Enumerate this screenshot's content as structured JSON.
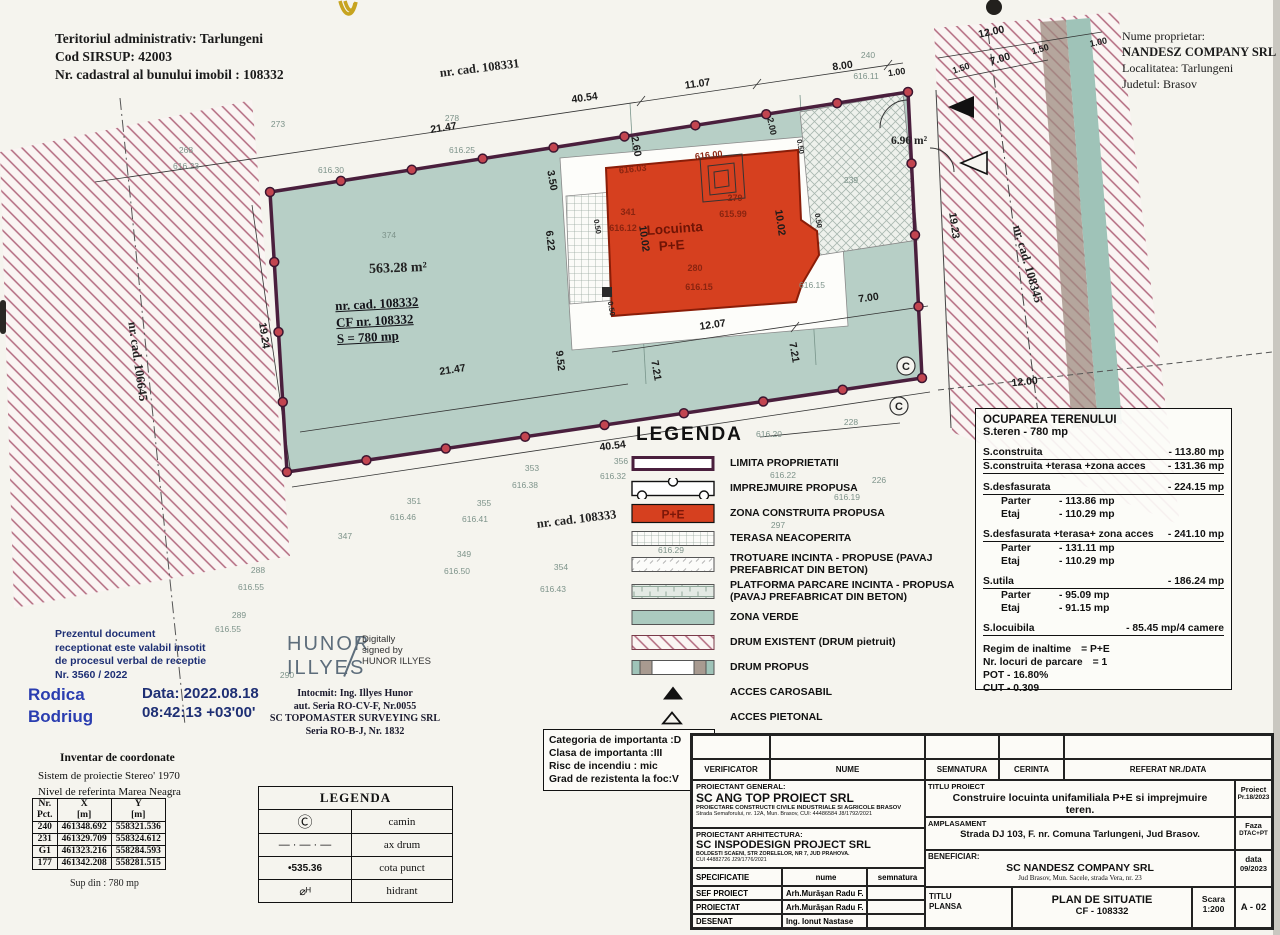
{
  "header": {
    "admin": [
      "Teritoriul administrativ: Tarlungeni",
      "Cod SIRSUP:  42003",
      "Nr. cadastral al bunului imobil : 108332"
    ],
    "owner": [
      "Nume proprietar:",
      "NANDESZ COMPANY SRL",
      "Localitatea: Tarlungeni",
      "Judetul: Brasov"
    ]
  },
  "plan": {
    "parcel_id": [
      "nr. cad. 108332",
      "CF nr. 108332",
      "S = 780 mp"
    ],
    "boundary": [
      [
        270,
        192
      ],
      [
        908,
        92
      ],
      [
        922,
        378
      ],
      [
        287,
        472
      ]
    ],
    "marker_counts": [
      9,
      4,
      8,
      4
    ],
    "colors": {
      "green": "#b7cfc6",
      "boundary": "#4a1f3d",
      "marker": "#c24550",
      "building": "#d6401f",
      "hatch": "#b2697e",
      "strip_teal": "#9fc3b8",
      "strip_brown": "#9d8b80"
    },
    "labels": [
      [
        "nr. cad. 108331",
        480,
        72,
        -7,
        "cad"
      ],
      [
        "40.54",
        585,
        101,
        -8,
        "dim"
      ],
      [
        "11.07",
        698,
        87,
        -8,
        "dim"
      ],
      [
        "8.00",
        843,
        69,
        -8,
        "dim"
      ],
      [
        "1.00",
        897,
        75,
        -8,
        "dims"
      ],
      [
        "240",
        868,
        58,
        0,
        "faint"
      ],
      [
        "616.11",
        866,
        79,
        0,
        "faint"
      ],
      [
        "12.00",
        992,
        35,
        -12,
        "dim"
      ],
      [
        "1.00",
        1099,
        45,
        -12,
        "dims"
      ],
      [
        "1.50",
        962,
        71,
        -18,
        "dims"
      ],
      [
        "7.00",
        1001,
        62,
        -16,
        "dim"
      ],
      [
        "1.50",
        1041,
        52,
        -16,
        "dims"
      ],
      [
        "19.23",
        951,
        226,
        82,
        "dim"
      ],
      [
        "nr. cad. 108345",
        1024,
        265,
        74,
        "cad"
      ],
      [
        "nr. cad. 106645",
        134,
        362,
        82,
        "cad"
      ],
      [
        "19.24",
        261,
        336,
        82,
        "dim"
      ],
      [
        "21.47",
        444,
        131,
        -9,
        "dim"
      ],
      [
        "268",
        186,
        153,
        0,
        "faint"
      ],
      [
        "616.23",
        186,
        169,
        0,
        "faint"
      ],
      [
        "273",
        278,
        127,
        0,
        "faint"
      ],
      [
        "278",
        452,
        121,
        0,
        "faint"
      ],
      [
        "616.30",
        331,
        173,
        0,
        "faint"
      ],
      [
        "616.25",
        462,
        153,
        0,
        "faint"
      ],
      [
        "2.60",
        633,
        147,
        80,
        "dim"
      ],
      [
        "3.50",
        549,
        181,
        80,
        "dim"
      ],
      [
        "2.00",
        769,
        127,
        78,
        "dims"
      ],
      [
        "6.22",
        547,
        241,
        84,
        "dim"
      ],
      [
        "9.52",
        557,
        361,
        84,
        "dim"
      ],
      [
        "10.02",
        641,
        239,
        82,
        "dim"
      ],
      [
        "10.02",
        777,
        223,
        82,
        "dim"
      ],
      [
        "21.47",
        453,
        373,
        -9,
        "dim"
      ],
      [
        "7.21",
        653,
        371,
        80,
        "dim"
      ],
      [
        "7.21",
        791,
        353,
        80,
        "dim"
      ],
      [
        "12.07",
        713,
        328,
        -8,
        "dim"
      ],
      [
        "7.00",
        869,
        301,
        -8,
        "dim"
      ],
      [
        "563.28 m²",
        398,
        272,
        -2,
        "area"
      ],
      [
        "Locuinta",
        675,
        233,
        -4,
        "bld"
      ],
      [
        "P+E",
        672,
        250,
        -4,
        "bld"
      ],
      [
        "616.03",
        633,
        172,
        -6,
        "red"
      ],
      [
        "616.00",
        709,
        158,
        -6,
        "red"
      ],
      [
        "341",
        628,
        215,
        0,
        "red"
      ],
      [
        "616.12",
        623,
        231,
        0,
        "red"
      ],
      [
        "279",
        735,
        201,
        0,
        "red"
      ],
      [
        "615.99",
        733,
        217,
        0,
        "red"
      ],
      [
        "280",
        695,
        271,
        0,
        "red"
      ],
      [
        "616.15",
        699,
        290,
        0,
        "red"
      ],
      [
        "616.15",
        812,
        288,
        0,
        "faint"
      ],
      [
        "239",
        851,
        183,
        0,
        "faint"
      ],
      [
        "6.96 m²",
        909,
        144,
        0,
        "areas"
      ],
      [
        "0.50",
        798,
        147,
        80,
        "box"
      ],
      [
        "0.50",
        595,
        227,
        80,
        "box"
      ],
      [
        "0.50",
        816,
        221,
        80,
        "box"
      ],
      [
        "0.50",
        609,
        309,
        80,
        "box"
      ],
      [
        "40.54",
        613,
        449,
        -7,
        "dim"
      ],
      [
        "356",
        621,
        464,
        0,
        "faint"
      ],
      [
        "616.32",
        613,
        479,
        0,
        "faint"
      ],
      [
        "228",
        851,
        425,
        0,
        "faint"
      ],
      [
        "616.20",
        769,
        437,
        0,
        "faint"
      ],
      [
        "616.22",
        783,
        478,
        0,
        "faint"
      ],
      [
        "226",
        879,
        483,
        0,
        "faint"
      ],
      [
        "616.19",
        847,
        500,
        0,
        "faint"
      ],
      [
        "353",
        532,
        471,
        0,
        "faint"
      ],
      [
        "616.38",
        525,
        488,
        0,
        "faint"
      ],
      [
        "351",
        414,
        504,
        0,
        "faint"
      ],
      [
        "616.46",
        403,
        520,
        0,
        "faint"
      ],
      [
        "355",
        484,
        506,
        0,
        "faint"
      ],
      [
        "616.41",
        475,
        522,
        0,
        "faint"
      ],
      [
        "nr. cad. 108333",
        577,
        523,
        -7,
        "cad"
      ],
      [
        "347",
        345,
        539,
        0,
        "faint"
      ],
      [
        "349",
        464,
        557,
        0,
        "faint"
      ],
      [
        "616.50",
        457,
        574,
        0,
        "faint"
      ],
      [
        "354",
        561,
        570,
        0,
        "faint"
      ],
      [
        "616.43",
        553,
        592,
        0,
        "faint"
      ],
      [
        "288",
        258,
        573,
        0,
        "faint"
      ],
      [
        "616.55",
        251,
        590,
        0,
        "faint"
      ],
      [
        "289",
        239,
        618,
        0,
        "faint"
      ],
      [
        "616.55",
        228,
        632,
        0,
        "faint"
      ],
      [
        "290",
        287,
        678,
        0,
        "faint"
      ],
      [
        "374",
        389,
        238,
        0,
        "faint"
      ],
      [
        "12.00",
        1025,
        385,
        -6,
        "dim"
      ],
      [
        "297",
        778,
        528,
        0,
        "faint"
      ],
      [
        "616.25",
        669,
        569,
        0,
        "faint"
      ],
      [
        "616.29",
        671,
        553,
        0,
        "faint"
      ],
      [
        "C",
        906,
        370,
        0,
        "sym"
      ],
      [
        "C",
        899,
        410,
        0,
        "sym"
      ]
    ]
  },
  "legend_main": {
    "title": "LEGENDA",
    "items": [
      {
        "sym": "limita",
        "label": "LIMITA PROPRIETATII"
      },
      {
        "sym": "imprejmuire",
        "label": "IMPREJMUIRE PROPUSA"
      },
      {
        "sym": "zona-construita",
        "sym_text": "P+E",
        "label": "ZONA CONSTRUITA PROPUSA"
      },
      {
        "sym": "terasa",
        "label": "TERASA NEACOPERITA"
      },
      {
        "sym": "trotuare",
        "label": "TROTUARE INCINTA - PROPUSE (PAVAJ\nPREFABRICAT DIN BETON)"
      },
      {
        "sym": "platforma",
        "label": "PLATFORMA PARCARE INCINTA - PROPUSA\n(PAVAJ PREFABRICAT DIN BETON)"
      },
      {
        "sym": "zona-verde",
        "label": "ZONA VERDE"
      },
      {
        "sym": "drum-existent",
        "label": "DRUM EXISTENT (DRUM pietruit)"
      },
      {
        "sym": "drum-propus",
        "label": "DRUM PROPUS"
      },
      {
        "sym": "acces-carosabil",
        "label": "ACCES CAROSABIL"
      },
      {
        "sym": "acces-pietonal",
        "label": "ACCES PIETONAL"
      }
    ]
  },
  "ocupare": {
    "title": "OCUPAREA TERENULUI",
    "subtitle": "S.teren - 780 mp",
    "rows": [
      {
        "type": "main",
        "label": "S.construita",
        "value": "- 113.80 mp"
      },
      {
        "type": "main",
        "label": "S.construita +terasa +zona acces",
        "value": "- 131.36 mp"
      },
      {
        "type": "gap"
      },
      {
        "type": "main",
        "label": "S.desfasurata",
        "value": "- 224.15 mp"
      },
      {
        "type": "sub",
        "label": "Parter",
        "value": "- 113.86 mp"
      },
      {
        "type": "sub",
        "label": "Etaj",
        "value": "- 110.29 mp"
      },
      {
        "type": "gap"
      },
      {
        "type": "main",
        "label": "S.desfasurata +terasa+ zona acces",
        "value": "- 241.10 mp"
      },
      {
        "type": "sub",
        "label": "Parter",
        "value": "- 131.11 mp"
      },
      {
        "type": "sub",
        "label": "Etaj",
        "value": "- 110.29 mp"
      },
      {
        "type": "gap"
      },
      {
        "type": "main",
        "label": "S.utila",
        "value": "- 186.24 mp"
      },
      {
        "type": "sub",
        "label": "Parter",
        "value": "- 95.09 mp"
      },
      {
        "type": "sub",
        "label": "Etaj",
        "value": "- 91.15 mp"
      },
      {
        "type": "gap"
      },
      {
        "type": "main",
        "label": "S.locuibila",
        "value": "- 85.45 mp/4 camere"
      },
      {
        "type": "gap"
      },
      {
        "type": "plain",
        "label": "Regim de inaltime",
        "value": "= P+E"
      },
      {
        "type": "plain",
        "label": "Nr. locuri de parcare",
        "value": "= 1"
      },
      {
        "type": "plain",
        "label": "POT - 16.80%",
        "value": ""
      },
      {
        "type": "plain",
        "label": "CUT - 0.309",
        "value": ""
      }
    ]
  },
  "stamp": {
    "text": "Prezentul document\nreceptionat este valabil insotit\nde procesul verbal de receptie\nNr. 3560 / 2022",
    "name1": "Rodica",
    "name2": "Bodriug",
    "date1": "Data: 2022.08.18",
    "date2": "08:42:13 +03'00'"
  },
  "signer": {
    "name1": "HUNOR",
    "name2": "ILLYES",
    "note": "Digitally\nsigned by\nHUNOR ILLYES",
    "det1": "Intocmit: Ing. Illyes Hunor",
    "det2": "aut. Seria RO-CV-F, Nr.0055",
    "det3": "SC TOPOMASTER SURVEYING SRL",
    "det4": "Seria RO-B-J, Nr. 1832"
  },
  "coords": {
    "title": "Inventar de coordonate",
    "sub1": "Sistem de proiectie Stereo' 1970",
    "sub2": "Nivel de referinta Marea Neagra",
    "col1": "Nr.\nPct.",
    "col2": "X\n[m]",
    "col3": "Y\n[m]",
    "rows": [
      [
        "240",
        "461348.692",
        "558321.536"
      ],
      [
        "231",
        "461329.709",
        "558324.612"
      ],
      [
        "G1",
        "461323.216",
        "558284.593"
      ],
      [
        "177",
        "461342.208",
        "558281.515"
      ]
    ],
    "footer": "Sup din : 780 mp"
  },
  "legend_small": {
    "title": "LEGENDA",
    "rows": [
      {
        "sym": "camin",
        "sym_text": "Ⓒ",
        "label": "camin"
      },
      {
        "sym": "ax-drum",
        "sym_text": "— · — · —",
        "label": "ax drum"
      },
      {
        "sym": "cota-punct",
        "sym_text": "•535.36",
        "label": "cota punct"
      },
      {
        "sym": "hidrant",
        "sym_text": "⌀ᴴ",
        "label": "hidrant"
      }
    ]
  },
  "importance": [
    "Categoria de importanta :D",
    "Clasa de importanta :III",
    "Risc de incendiu : mic",
    "Grad de rezistenta la foc:V"
  ],
  "title_block": {
    "verificator": "VERIFICATOR",
    "nume": "NUME",
    "semnatura": "SEMNATURA",
    "cerinta": "CERINTA",
    "referat": "REFERAT NR./DATA",
    "pg_label": "PROIECTANT GENERAL:",
    "pg_name": "SC ANG TOP PROIECT SRL",
    "pg_line1": "PROIECTARE CONSTRUCTII CIVILE INDUSTRIALE SI AGRICOLE BRASOV",
    "pg_line2": "Strada Semaforului, nr. 12A, Mun. Brasov, CUI: 44486584        J8/1792/2021",
    "pa_label": "PROIECTANT ARHITECTURA:",
    "pa_name": "SC INSPODESIGN PROJECT SRL",
    "pa_line1": "BOLDESTI SCAENI, STR ZORELELOR, NR 7, JUD PRAHOVA.",
    "pa_line2": "CUI 44882726          J29/1776/2021",
    "titlu_proiect_label": "TITLU PROIECT",
    "titlu_proiect": "Construire locuinta unifamiliala P+E si imprejmuire teren.",
    "proiect_label": "Proiect",
    "proiect_nr": "Pr.18/2023",
    "amplasament_label": "AMPLASAMENT",
    "amplasament": "Strada DJ 103, F. nr. Comuna Tarlungeni, Jud Brasov.",
    "faza_label": "Faza",
    "faza": "DTAC+PT",
    "spec": "SPECIFICATIE",
    "spec_nume": "nume",
    "spec_semnatura": "semnatura",
    "spec_rows": [
      [
        "SEF PROIECT",
        "Arh.Murăşan Radu F."
      ],
      [
        "PROIECTAT",
        "Arh.Murăşan Radu F."
      ],
      [
        "DESENAT",
        "Ing. Ionut Nastase"
      ]
    ],
    "beneficiar_label": "BENEFICIAR:",
    "beneficiar": "SC NANDESZ COMPANY SRL",
    "beneficiar_addr": "Jud Brasov, Mun. Sacele, strada Vera, nr. 23",
    "data_label": "data",
    "data": "09/2023",
    "titlu_plansa_label": "TITLU\nPLANSA",
    "plansa": "PLAN DE SITUATIE",
    "plansa_cf": "CF - 108332",
    "scara_label": "Scara",
    "scara": "1:200",
    "plansa_nr": "A - 02"
  }
}
